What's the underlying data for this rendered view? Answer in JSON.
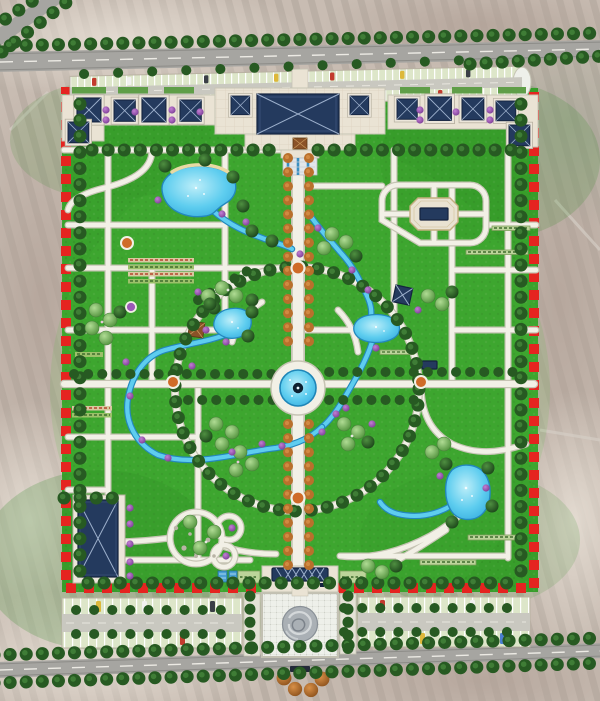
{
  "meta": {
    "type": "landscape-architecture-master-plan-rendering",
    "description": "Top-down rendered master plan of a rectangular park bounded by a red dashed property line, set in faded sepia farmland aerial context with tree-lined perimeter roads",
    "visible_text": "none"
  },
  "palette": {
    "contextBase": "#c8bcb2",
    "contextShadeDark": "#b2a298",
    "contextShadeLight": "#e0d8cf",
    "road": "#a6a5a1",
    "roadEdge": "#8d8c88",
    "roadDash": "#eceae4",
    "lawn": "#3aa22d",
    "lawnShade": "#2e8a24",
    "lawnLight": "#54c040",
    "treeDark": "#275a22",
    "treeDarkHi": "#3f7d36",
    "treeOrange": "#b9702c",
    "treeOrangeHi": "#d28a42",
    "treeLight": "#82c263",
    "treeLightHi": "#a9da8c",
    "shrubPurple": "#9b59b6",
    "water": "#5ecdef",
    "waterDeep": "#2fa7dc",
    "waterEdge": "#2387bd",
    "sand": "#e8d9a4",
    "path": "#f2f0e6",
    "pathEdge": "#c6c4b4",
    "plaza": "#eae3d4",
    "plazaLine": "#d6cbb9",
    "roofNavy": "#243a5e",
    "roofDark": "#14233f",
    "roofLine": "#9db0cc",
    "boundaryRed": "#e52420",
    "stallGreen": "#dde6c9",
    "stallLine": "#ffffff",
    "aisle": "#c9c8c0",
    "hedge": "#bcd49a",
    "hedgeDark": "#7d9e5c",
    "hedgeTan": "#d8c8a0",
    "hedgeRed": "#b2452e",
    "medallion": "#aab0b5",
    "medallionHi": "#d4d8da",
    "medallionLo": "#7b828a",
    "nodeOrange": "#cf6b28",
    "pavilionBrown": "#8a5228",
    "poolBlue": "#4aa0d4",
    "gravel": "#b9b4a6",
    "carRed": "#c23b2e",
    "carYellow": "#ddb83a",
    "carWhite": "#f2f2f0",
    "carBlue": "#4a7fd1",
    "carDark": "#3a3f46"
  },
  "features": {
    "boundary": "red-dashed-site-boundary-rectangle",
    "roads": [
      "north-perimeter-road-diagonal",
      "northwest-corner-road",
      "south-perimeter-road"
    ],
    "north_zone": {
      "main_hall": "large-navy-hip-roof-building-on-paved-plaza",
      "flanking_pavilions": "two-small-navy-roof-pavilions",
      "west_pavilion_row": 5,
      "east_pavilion_row": 5,
      "roadside_parking": "double-row-parking-strip-with-cars"
    },
    "park": {
      "central_axis": "orange-tree-lined-boulevard-north-south",
      "central_fountain": "circular-blue-pool-with-dark-center-jet",
      "great_ring": "tree-lined-circular-loop-path",
      "cross_path": "tree-lined-east-west-path-through-fountain",
      "ponds": [
        "northwest-kidney-pond",
        "west-small-pond",
        "east-pond",
        "southeast-teardrop-pond"
      ],
      "streams": "winding-blue-streams-linking-ponds",
      "northeast_court": "rounded-loop-with-octagonal-stage-plaza",
      "southwest_hall": "tall-navy-roof-building",
      "southwest_garden": "three-circular-garden-paths",
      "planting_beds": "striped-nursery-hedge-strips",
      "path_grid": "orthogonal-white-paths-west-and-east",
      "nodes": "small-orange-and-purple-circular-plazas"
    },
    "south_zone": {
      "gate": "navy-lattice-canopy-entrance",
      "plaza": "paved-grid-square-with-round-stone-medallion",
      "pools": "two-small-blue-pools-west-of-gate",
      "parking_lots": 2,
      "forecourt": "four-orange-trees-and-sign-below-road"
    }
  }
}
